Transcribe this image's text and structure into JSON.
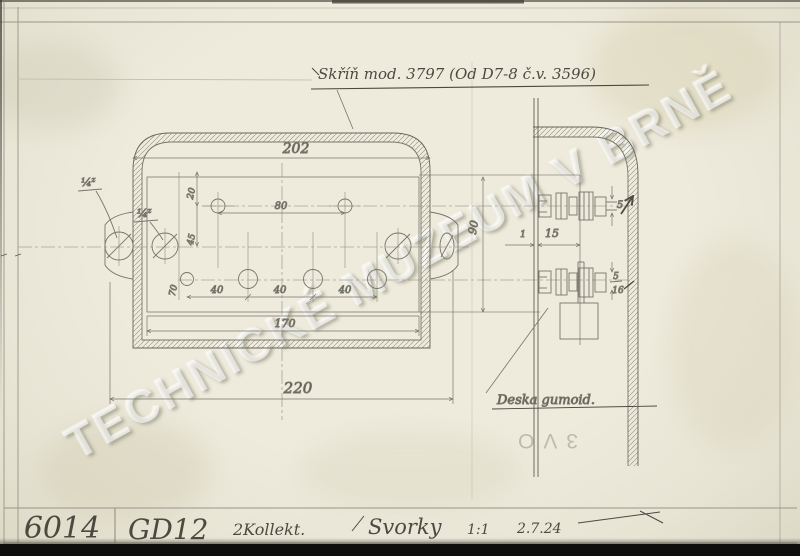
{
  "annotations": {
    "case_note": "Skříň mod. 3797 (Od D7-8 č.v. 3596)",
    "plate_note": "Deska gumoid.",
    "stamp": "3VO",
    "watermark": "TECHNICKÉ MUZEUM V BRNĚ"
  },
  "title_block": {
    "inventory_number": "6014",
    "type_code": "GD12",
    "component": "2Kollekt.",
    "part_name": "Svorky",
    "scale": "1:1",
    "date": "2.7.24"
  },
  "dims": {
    "width_outer": "202",
    "width_plate": "170",
    "width_total": "220",
    "height_plate": "90",
    "hole_top_spacing": "80",
    "offset_top": "20",
    "offset_mid": "45",
    "offset_low": "70",
    "spacing_a": "40",
    "spacing_b": "40",
    "spacing_c": "40",
    "gap": "15",
    "thickness": "1",
    "bolt_dia": "5",
    "frac_num": "5",
    "frac_den": "16",
    "thread_a": "¼",
    "thread_a_sup": "z",
    "thread_b": "¼",
    "thread_b_sup": "z"
  }
}
